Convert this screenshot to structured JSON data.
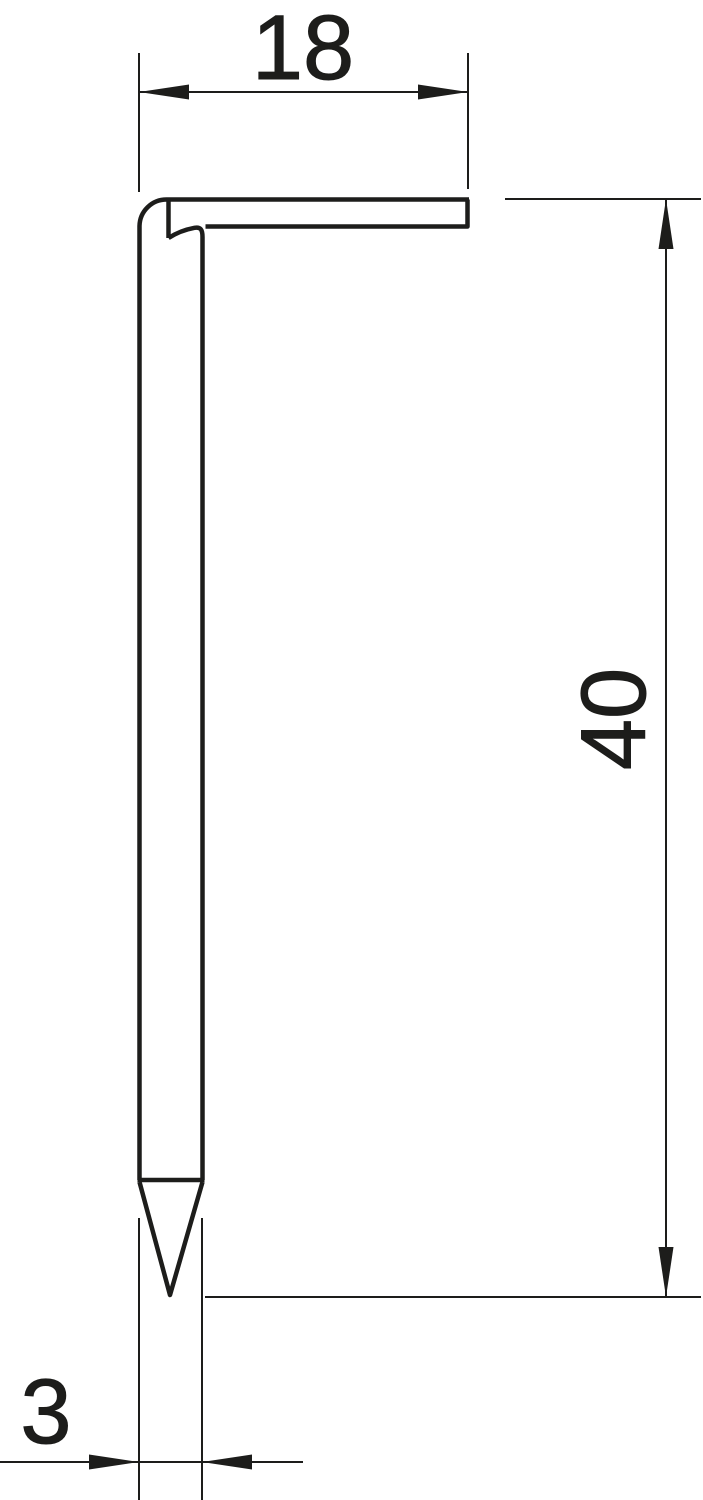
{
  "drawing": {
    "title": "hook-nail side profile dimension drawing",
    "background_color": "#ffffff",
    "line_color": "#1d1d1b",
    "dimensions": {
      "hook_width": {
        "value": "18",
        "orientation": "horizontal",
        "position": "top"
      },
      "shank_length": {
        "value": "40",
        "orientation": "vertical",
        "position": "right"
      },
      "shank_diameter": {
        "value": "3",
        "orientation": "horizontal",
        "position": "bottom-left"
      }
    }
  }
}
